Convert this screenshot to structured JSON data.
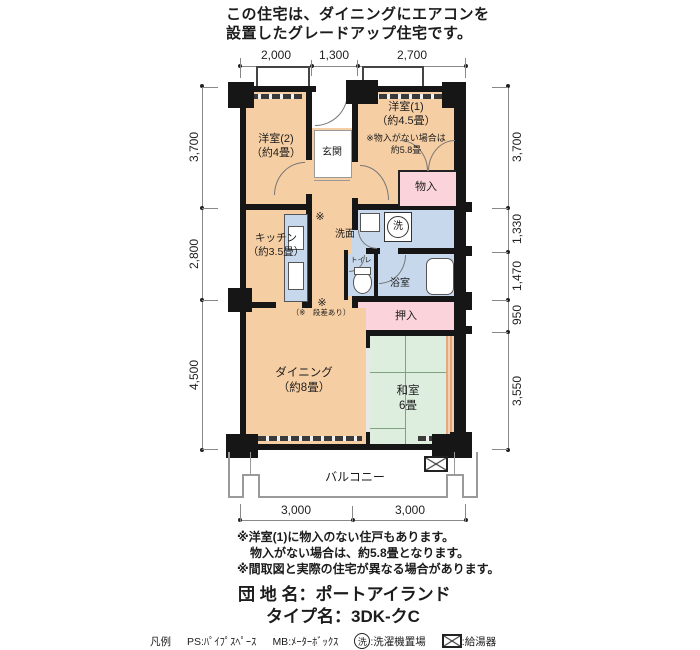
{
  "header": {
    "line1": "この住宅は、ダイニングにエアコンを",
    "line2": "設置したグレードアップ住宅です。"
  },
  "dimensions": {
    "top": [
      "2,000",
      "1,300",
      "2,700"
    ],
    "left": [
      "3,700",
      "2,800",
      "4,500"
    ],
    "right": [
      "3,700",
      "1,330",
      "1,470",
      "950",
      "3,550"
    ],
    "bottom": [
      "3,000",
      "3,000"
    ]
  },
  "rooms": {
    "yoshitsu2": {
      "name": "洋室(2)",
      "size": "（約4畳）"
    },
    "genkan": {
      "name": "玄関"
    },
    "yoshitsu1": {
      "name": "洋室(1)",
      "size": "（約4.5畳）",
      "note_line1": "※物入がない場合は",
      "note_line2": "約5.8畳"
    },
    "monoire": {
      "name": "物入"
    },
    "kitchen": {
      "name": "キッチン",
      "size": "（約3.5畳）"
    },
    "senmen": {
      "name": "洗面"
    },
    "washer_symbol": "洗",
    "toilet": {
      "name": "トイレ"
    },
    "bath": {
      "name": "浴室"
    },
    "oshiire": {
      "name": "押入"
    },
    "dining": {
      "name": "ダイニング",
      "size": "（約8畳）"
    },
    "washitsu": {
      "name": "和室",
      "size": "6畳"
    },
    "balcony": {
      "name": "バルコニー"
    }
  },
  "plan_marks": {
    "asterisk": "※",
    "step_note": "（※　段差あり）"
  },
  "notes": [
    "※洋室(1)に物入のない住戸もあります。",
    "物入がない場合は、約5.8畳となります。",
    "※間取図と実際の住宅が異なる場合があります。"
  ],
  "title": {
    "estate_label": "団 地 名：",
    "estate_value": "ポートアイランド",
    "type_label": "タイプ名：",
    "type_value": "3DK-クC"
  },
  "legend": {
    "heading": "凡例",
    "ps": "PS:ﾊﾟｲﾌﾟｽﾍﾟｰｽ",
    "mb": "MB:ﾒｰﾀｰﾎﾞｯｸｽ",
    "washer_symbol": "洗",
    "washer_text": ":洗濯機置場",
    "heater_text": ":給湯器"
  },
  "colors": {
    "room_peach": "#F6CEA3",
    "closet_pink": "#FAD4DA",
    "wet_blue": "#C7D8EC",
    "tatami_green": "#DDEEDF",
    "wall_black": "#161616",
    "wood_tan": "#E2A87E"
  }
}
